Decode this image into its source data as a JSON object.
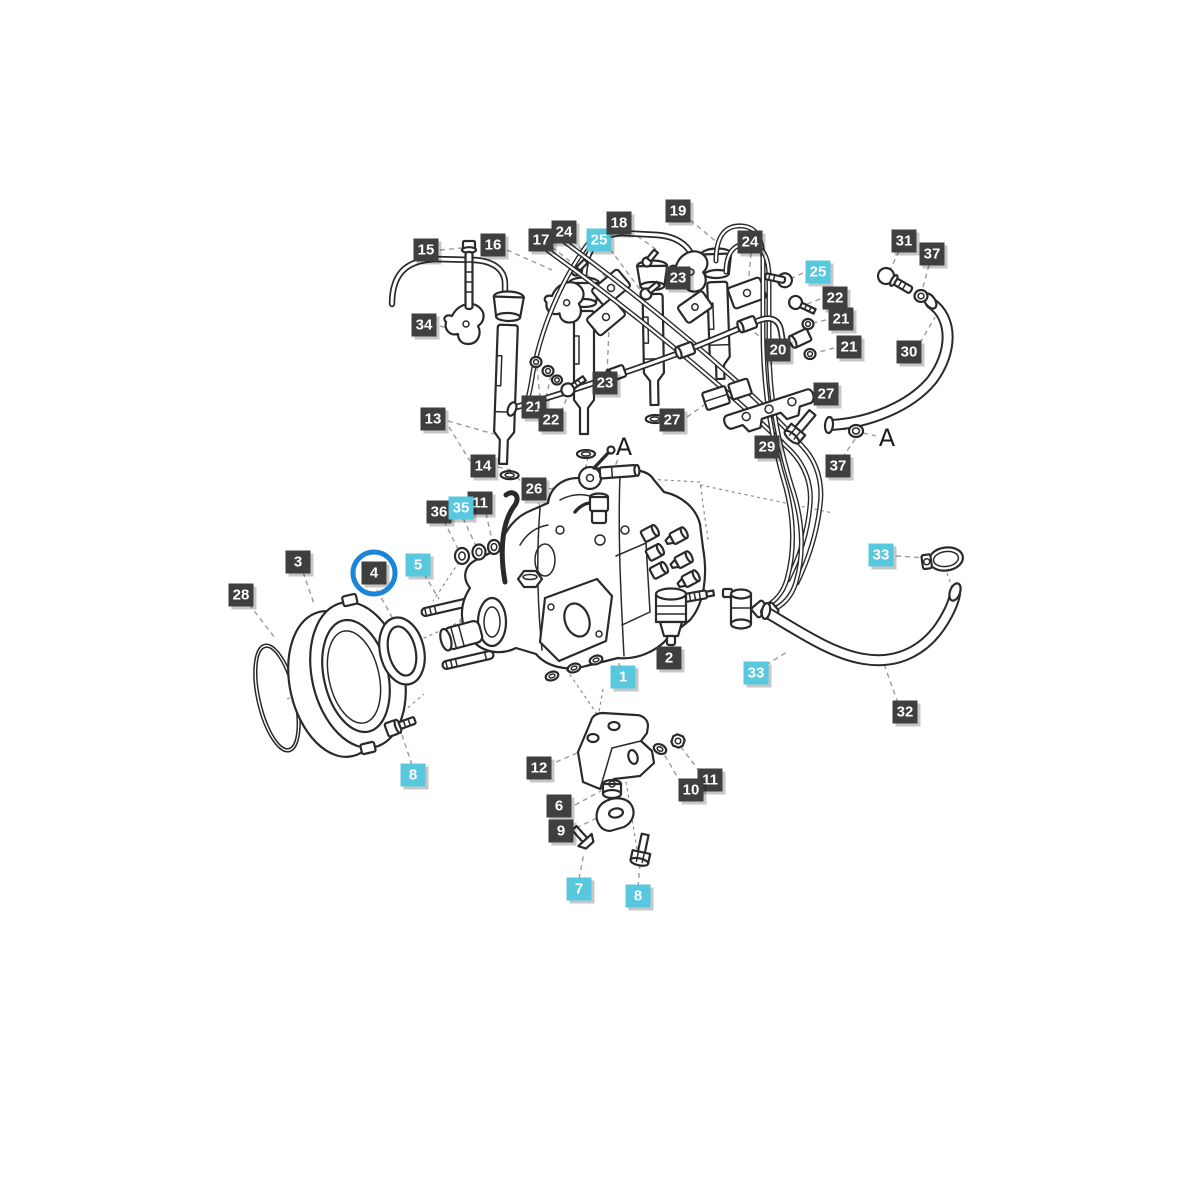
{
  "diagram": {
    "type": "exploded-parts-diagram",
    "colors": {
      "label_dark_bg": "#3f3f3f",
      "label_cyan_bg": "#57c8de",
      "label_text": "#ffffff",
      "highlight_circle": "#1b86d9",
      "line_art": "#2a2a2a",
      "leader_line": "#9b9b9b",
      "background": "#ffffff"
    },
    "connection_markers": [
      {
        "text": "A",
        "x": 624,
        "y": 447
      },
      {
        "text": "A",
        "x": 887,
        "y": 438
      }
    ],
    "labels": [
      {
        "text": "15",
        "variant": "dark",
        "x": 426,
        "y": 250
      },
      {
        "text": "16",
        "variant": "dark",
        "x": 493,
        "y": 245
      },
      {
        "text": "34",
        "variant": "dark",
        "x": 424,
        "y": 325
      },
      {
        "text": "17",
        "variant": "dark",
        "x": 541,
        "y": 240
      },
      {
        "text": "24",
        "variant": "dark",
        "x": 564,
        "y": 232
      },
      {
        "text": "25",
        "variant": "cyan",
        "x": 599,
        "y": 240
      },
      {
        "text": "18",
        "variant": "dark",
        "x": 619,
        "y": 223
      },
      {
        "text": "19",
        "variant": "dark",
        "x": 678,
        "y": 211
      },
      {
        "text": "23",
        "variant": "dark",
        "x": 678,
        "y": 278
      },
      {
        "text": "24",
        "variant": "dark",
        "x": 750,
        "y": 242
      },
      {
        "text": "25",
        "variant": "cyan",
        "x": 818,
        "y": 272
      },
      {
        "text": "31",
        "variant": "dark",
        "x": 904,
        "y": 241
      },
      {
        "text": "37",
        "variant": "dark",
        "x": 932,
        "y": 254
      },
      {
        "text": "22",
        "variant": "dark",
        "x": 835,
        "y": 298
      },
      {
        "text": "21",
        "variant": "dark",
        "x": 841,
        "y": 319
      },
      {
        "text": "20",
        "variant": "dark",
        "x": 778,
        "y": 350
      },
      {
        "text": "21",
        "variant": "dark",
        "x": 849,
        "y": 347
      },
      {
        "text": "30",
        "variant": "dark",
        "x": 909,
        "y": 352
      },
      {
        "text": "23",
        "variant": "dark",
        "x": 605,
        "y": 383
      },
      {
        "text": "27",
        "variant": "dark",
        "x": 826,
        "y": 394
      },
      {
        "text": "21",
        "variant": "dark",
        "x": 534,
        "y": 407
      },
      {
        "text": "13",
        "variant": "dark",
        "x": 433,
        "y": 419
      },
      {
        "text": "22",
        "variant": "dark",
        "x": 551,
        "y": 420
      },
      {
        "text": "27",
        "variant": "dark",
        "x": 672,
        "y": 420
      },
      {
        "text": "29",
        "variant": "dark",
        "x": 767,
        "y": 447
      },
      {
        "text": "37",
        "variant": "dark",
        "x": 838,
        "y": 466
      },
      {
        "text": "14",
        "variant": "dark",
        "x": 483,
        "y": 466
      },
      {
        "text": "26",
        "variant": "dark",
        "x": 534,
        "y": 489
      },
      {
        "text": "36",
        "variant": "dark",
        "x": 439,
        "y": 512
      },
      {
        "text": "11",
        "variant": "dark",
        "x": 480,
        "y": 503
      },
      {
        "text": "35",
        "variant": "cyan",
        "x": 461,
        "y": 508
      },
      {
        "text": "3",
        "variant": "dark",
        "x": 298,
        "y": 562
      },
      {
        "text": "4",
        "variant": "dark",
        "x": 374,
        "y": 573,
        "circled": true
      },
      {
        "text": "5",
        "variant": "cyan",
        "x": 418,
        "y": 565
      },
      {
        "text": "28",
        "variant": "dark",
        "x": 241,
        "y": 595
      },
      {
        "text": "2",
        "variant": "dark",
        "x": 669,
        "y": 658
      },
      {
        "text": "1",
        "variant": "cyan",
        "x": 623,
        "y": 677
      },
      {
        "text": "33",
        "variant": "cyan",
        "x": 881,
        "y": 555
      },
      {
        "text": "33",
        "variant": "cyan",
        "x": 756,
        "y": 673
      },
      {
        "text": "32",
        "variant": "dark",
        "x": 905,
        "y": 712
      },
      {
        "text": "12",
        "variant": "dark",
        "x": 539,
        "y": 768
      },
      {
        "text": "11",
        "variant": "dark",
        "x": 710,
        "y": 780
      },
      {
        "text": "10",
        "variant": "dark",
        "x": 691,
        "y": 790
      },
      {
        "text": "6",
        "variant": "dark",
        "x": 559,
        "y": 806
      },
      {
        "text": "9",
        "variant": "dark",
        "x": 561,
        "y": 831
      },
      {
        "text": "8",
        "variant": "cyan",
        "x": 413,
        "y": 775
      },
      {
        "text": "7",
        "variant": "cyan",
        "x": 579,
        "y": 889
      },
      {
        "text": "8",
        "variant": "cyan",
        "x": 638,
        "y": 896
      }
    ]
  }
}
